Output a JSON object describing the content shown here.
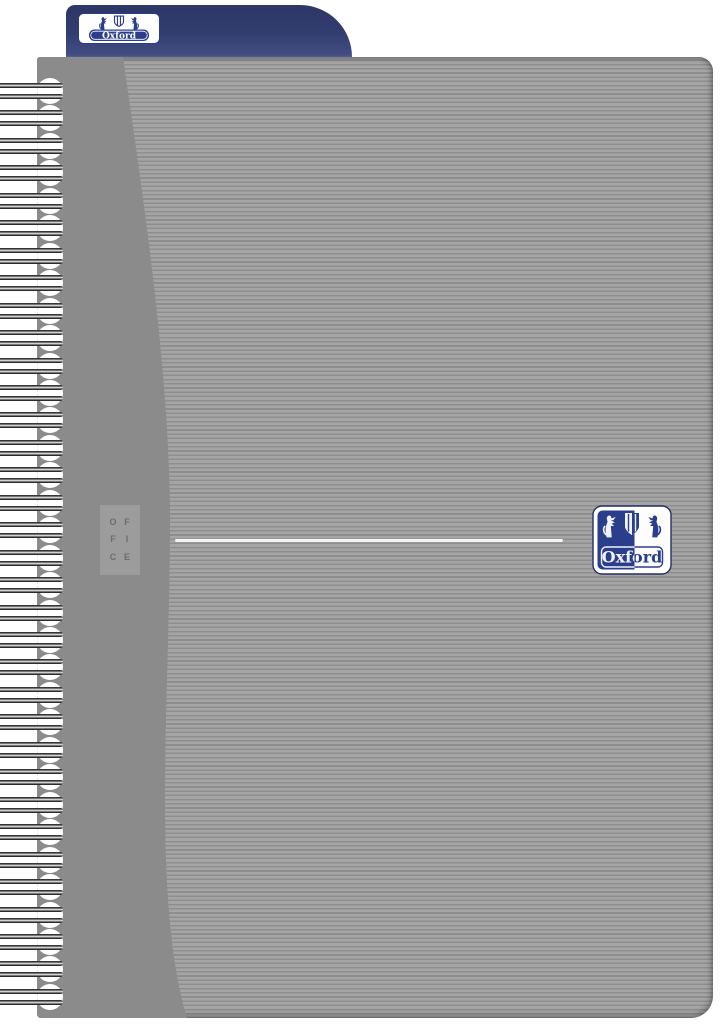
{
  "brand": {
    "wordmark": "Oxford"
  },
  "cover": {
    "series_letters": [
      "O",
      "F",
      "F",
      "I",
      "C",
      "E"
    ]
  },
  "spiral": {
    "ring_count": 34
  },
  "colors": {
    "tab_blue": "#323d70",
    "logo_blue": "#2b3e8c",
    "cover_solid_gray": "#8b8b8b",
    "stripe_light": "#a5a5a5",
    "stripe_dark": "#8e8e8e",
    "office_box_gray": "#9c9c9c",
    "office_letter_gray": "#6d6d6d",
    "divider_white": "#f3f3f3"
  }
}
